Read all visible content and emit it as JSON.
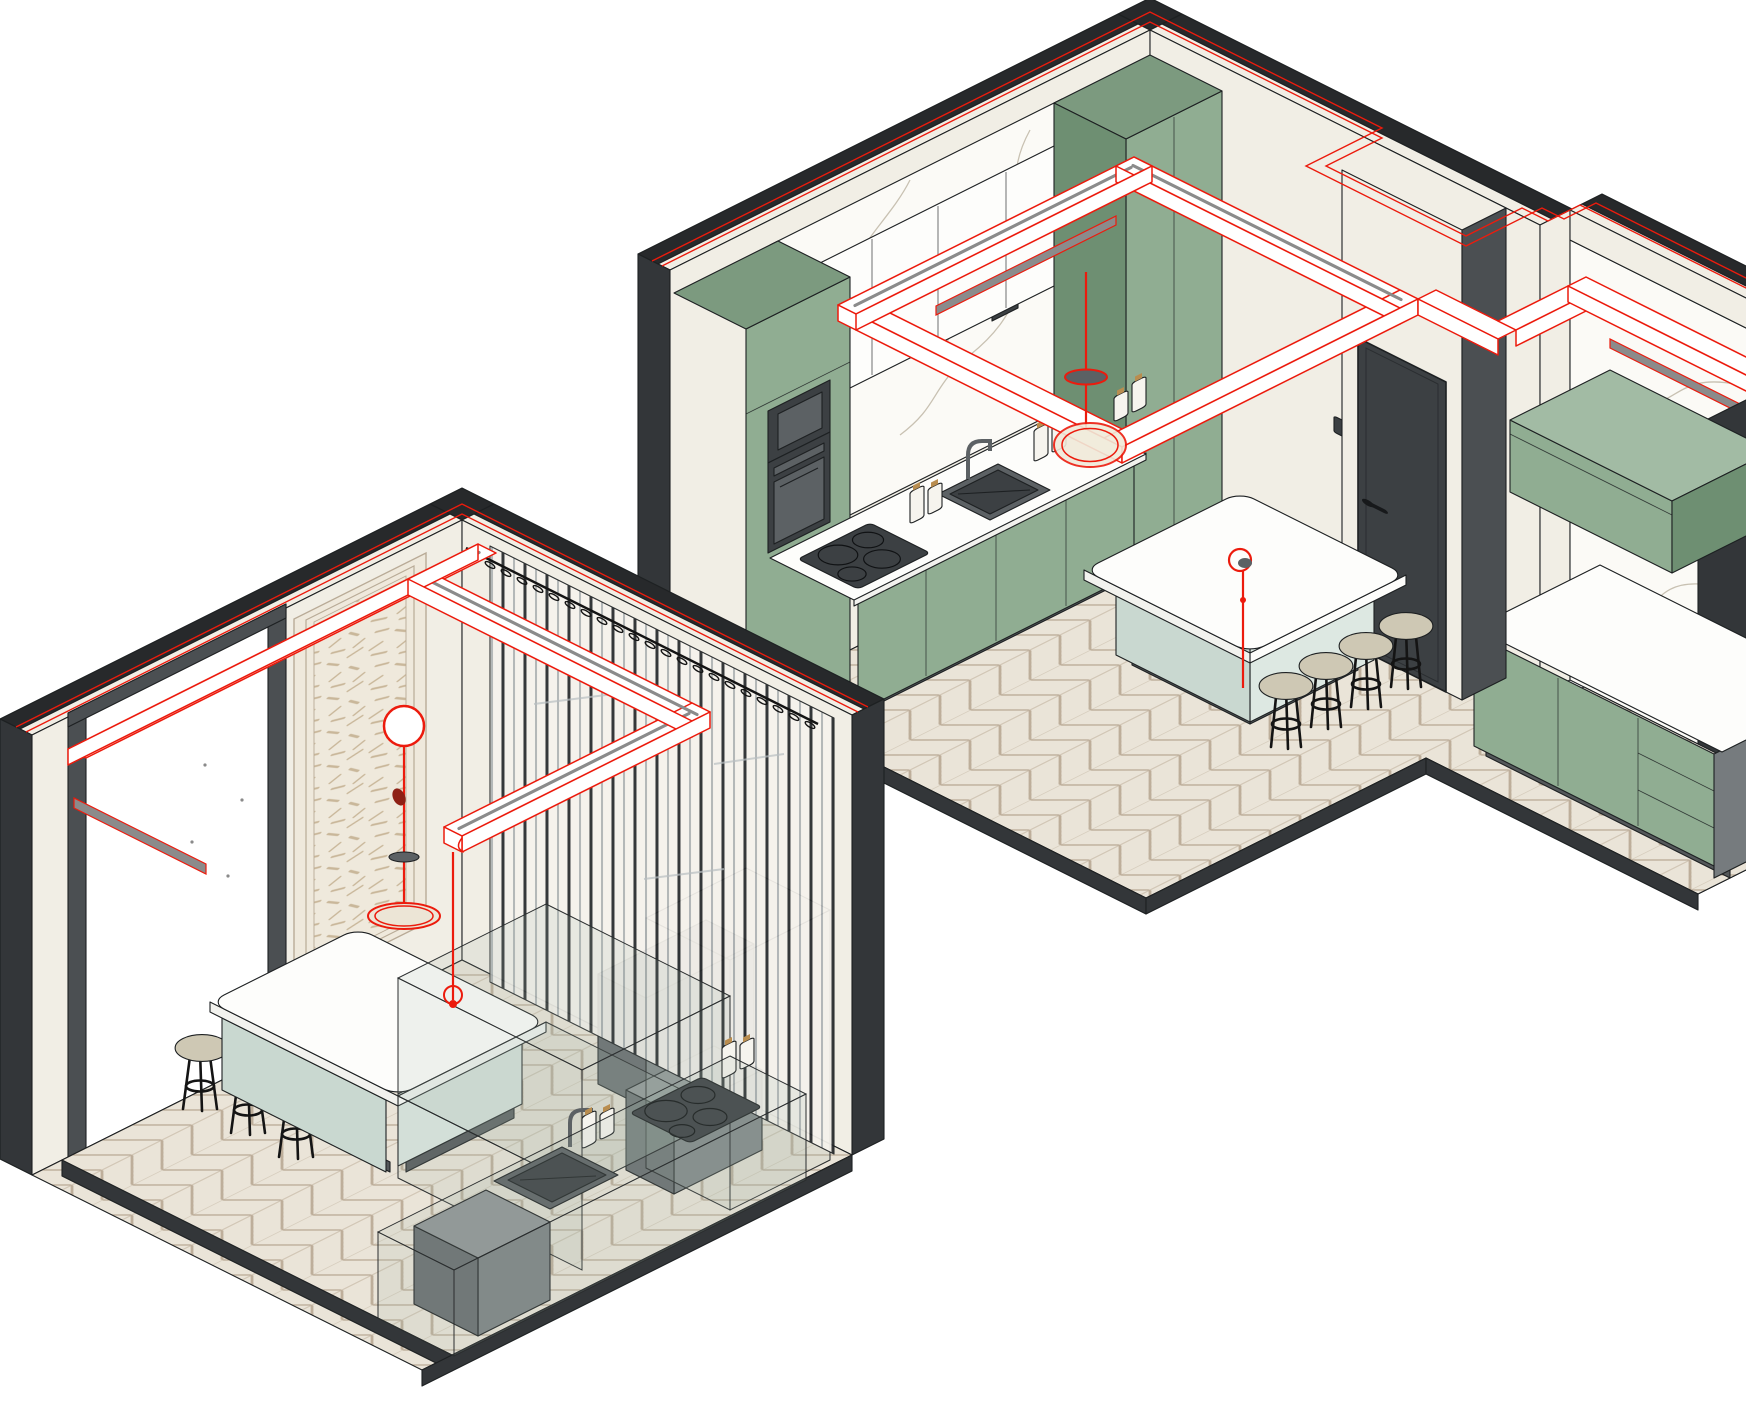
{
  "palette": {
    "bg": "#ffffff",
    "outline": "#1d2022",
    "wallDark": "#333639",
    "wallDarkTop": "#27292b",
    "wallSide": "#4b4f52",
    "cream": "#f1eee5",
    "creamShade": "#e6e2d5",
    "panelCream": "#efe9dc",
    "panelFrame": "#b9ab97",
    "green": "#90ad92",
    "greenDark": "#7c9a7f",
    "greenSide": "#6e8f72",
    "greenLight": "#a2bba4",
    "marble": "#fbfaf6",
    "vein": "#c3bbab",
    "floorTile": "#eae4d8",
    "floorLine": "#bdae9a",
    "plinth": "#54585a",
    "whiteCab": "#fdfdfb",
    "counterEdge": "#f2f2ee",
    "islandBase": "#dde8e2",
    "islandBaseShade": "#c9d8d0",
    "applianceDark": "#3c4043",
    "applianceMid": "#5c6164",
    "applianceLight": "#767b7e",
    "stoolSeat": "#cec8b4",
    "stoolFrame": "#141414",
    "red": "#ec1b0d",
    "darkRed": "#8e2015",
    "led": "#8b8b8b",
    "ghostFill": "#9fb4a6",
    "ghostLine": "#2a2d2e",
    "bottle": "#f6f4ee",
    "cork": "#b98d4f",
    "curtainDark": "#26292c",
    "curtainLight": "#9aa0a4",
    "terrazzoFleck": "#c9b79a",
    "grayBox": "#7d8284",
    "grayBoxSide": "#686d6f",
    "grayBoxTop": "#8f9496",
    "switchDark": "#2e3134"
  },
  "scene": {
    "projection": "2:1 axonometric",
    "rooms": [
      {
        "id": "room-upper-rendered",
        "style": "rendered",
        "bar_stool_count": 4,
        "cooktop_burner_count": 4,
        "bottle_count": 6,
        "elements": [
          "perimeter-dark-walls",
          "chevron-parquet-floor",
          "tall-oven-cabinet-column",
          "green-base-cabinet-run",
          "white-upper-cabinets",
          "marble-backsplash-wall",
          "sink-and-faucet",
          "induction-cooktop",
          "milk-bottles",
          "kitchen-island",
          "bar-stools",
          "suspended-track-light-ring",
          "track-linear-spotlight",
          "ring-pendant-light",
          "stem-pendant-light",
          "interior-door",
          "light-switch",
          "entry-alcove-green-cabinets",
          "floating-wall-cabinet",
          "alcove-marble-wall",
          "alcove-wall-track-light",
          "power-outlets"
        ]
      },
      {
        "id": "room-lower-wireframe",
        "style": "ghosted-wireframe",
        "bar_stool_count": 3,
        "cooktop_burner_count": 4,
        "bottle_count": 4,
        "elements": [
          "perimeter-dark-walls",
          "chevron-parquet-floor",
          "wall-opening",
          "decorative-terrazzo-panel",
          "panel-pendant-fixture",
          "vertical-slat-curtain",
          "curtain-rod-hooks",
          "ghost-counter-run",
          "gray-cabinet-box",
          "sink-and-faucet",
          "induction-cooktop",
          "milk-bottles",
          "appliance-boxes",
          "kitchen-island",
          "ghost-island-extension",
          "bar-stools",
          "suspended-track-light-beams",
          "track-linear-spotlight",
          "track-stem-pendant"
        ]
      }
    ]
  }
}
